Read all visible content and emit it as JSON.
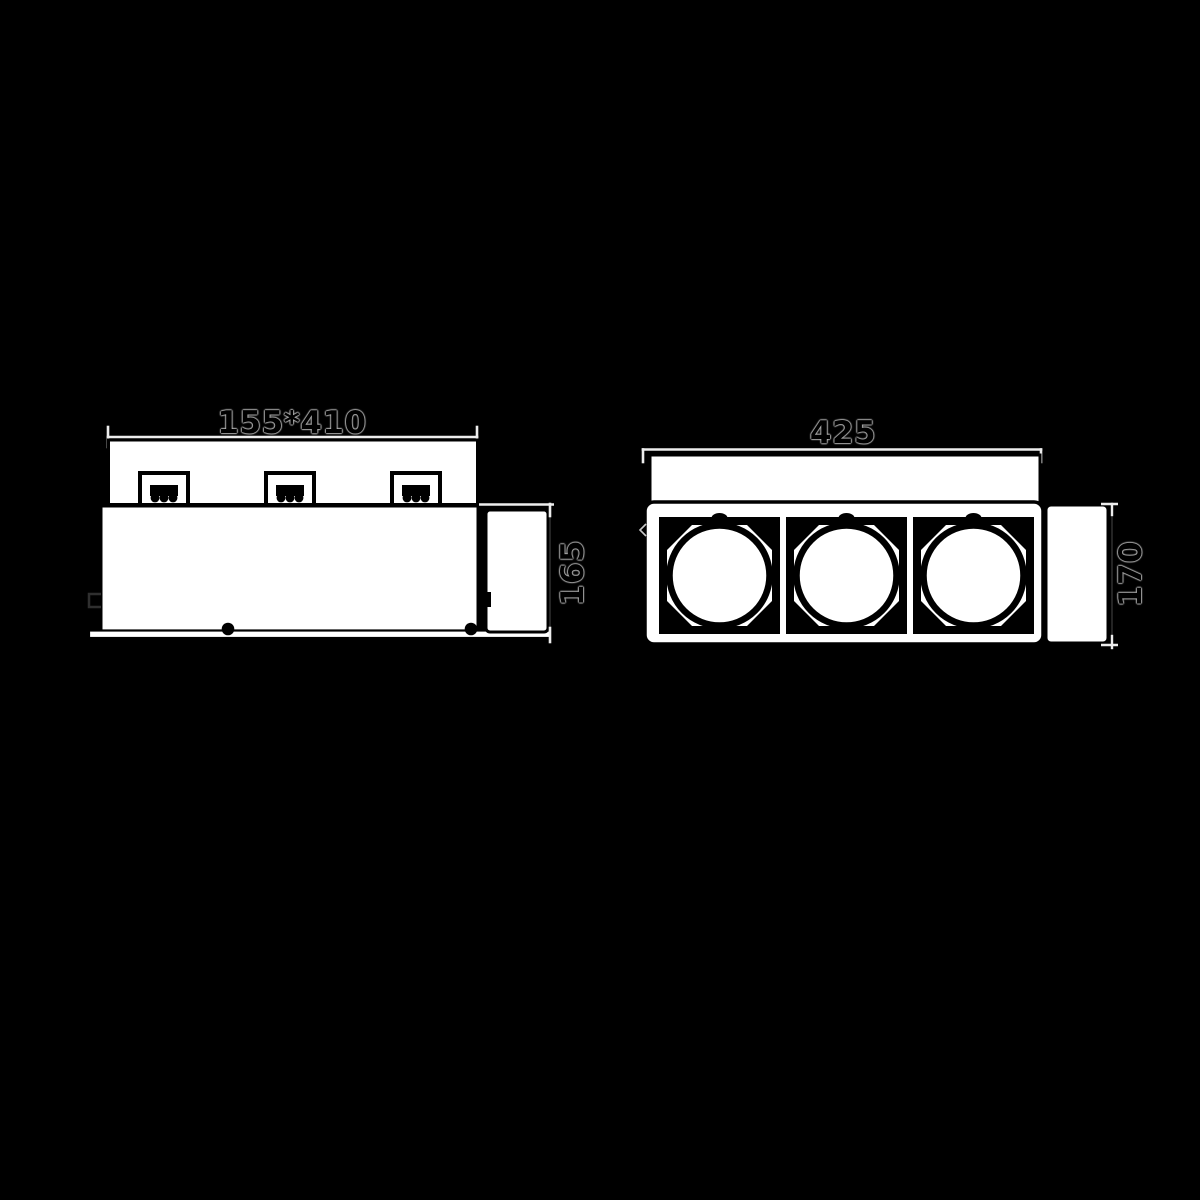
{
  "drawing": {
    "type": "technical-dimension-drawing",
    "subject": "three-lamp recessed grille spotlight",
    "colors": {
      "background": "#000000",
      "outline": "#000000",
      "shape_fill": "#ffffff",
      "dimension_line": "#ededed"
    },
    "views": {
      "side_view": {
        "width_label": "155*410",
        "height_label": "165",
        "terminal_block_count": 3
      },
      "front_view": {
        "width_label": "425",
        "height_label": "170",
        "lamp_count": 3
      }
    }
  }
}
